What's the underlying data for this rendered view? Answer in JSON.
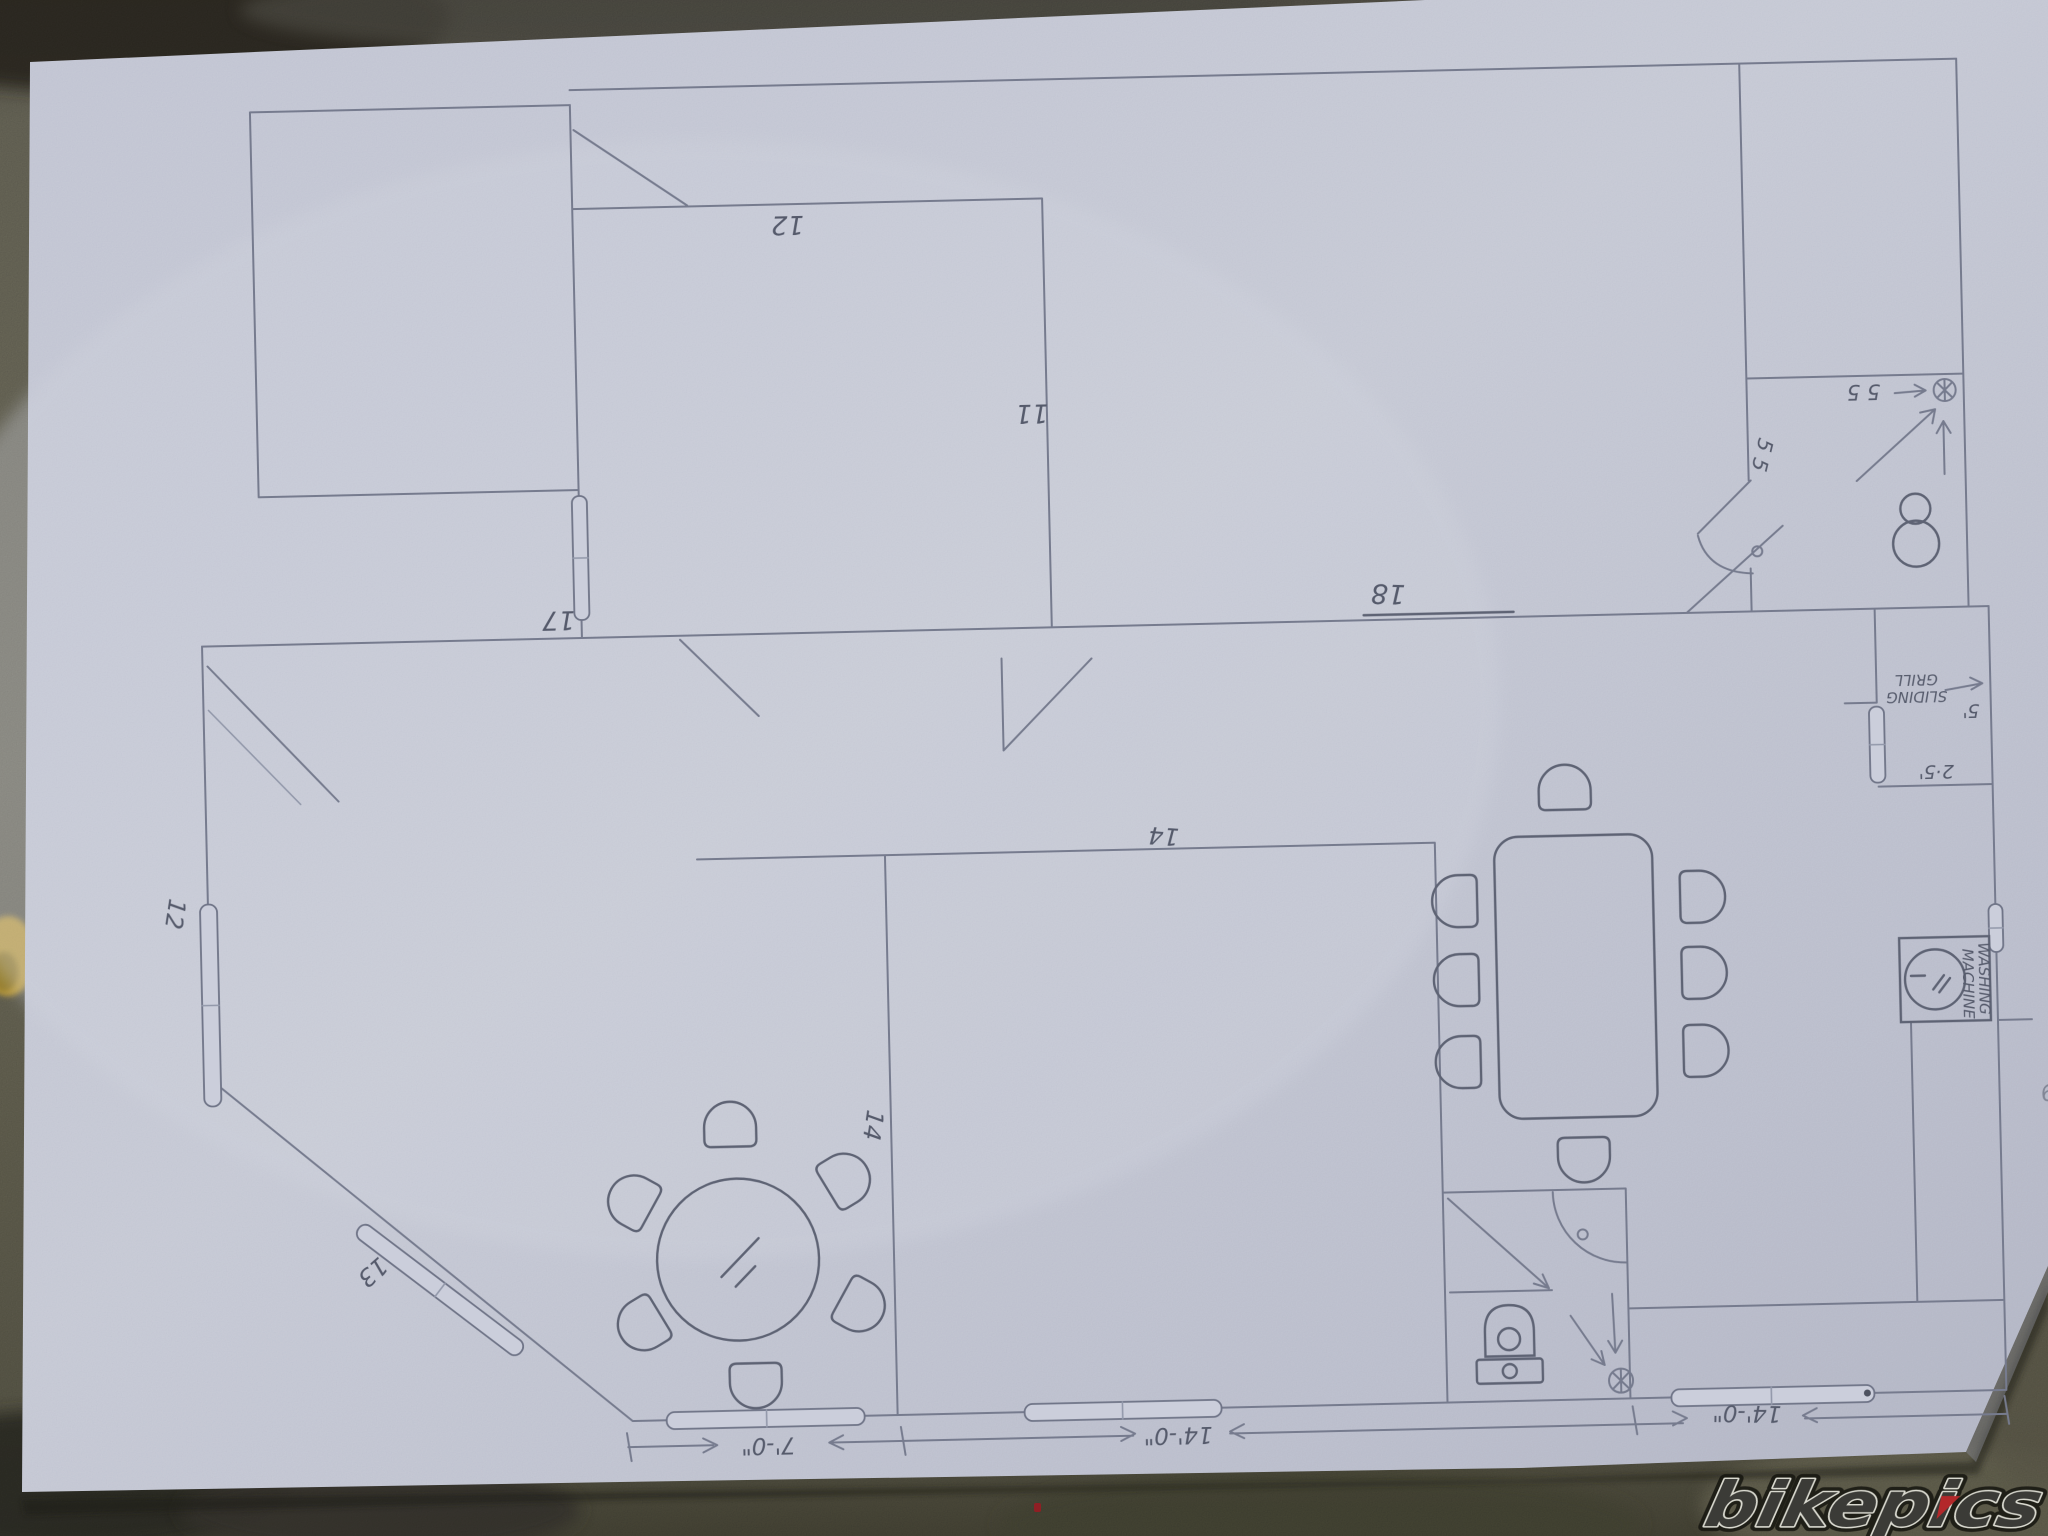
{
  "scene": {
    "description": "photo of a hand-drawn pencil floor plan on paper, upside-down, lying on concrete",
    "paper_color": "#c8cbd8",
    "pencil_color": "#767b8e",
    "concrete_color": "#6e6c5d",
    "watermark": {
      "text": "bikepics",
      "fill": "#3b3b37",
      "outline": "#d9d9cf",
      "accent_red": "#b3282a"
    }
  },
  "plan": {
    "labels": {
      "top_mid_width": "12",
      "top_mid_depth": "11",
      "big_room_width": "18",
      "living_width": "17",
      "left_window": "12",
      "diag_window": "13",
      "family_depth": "14",
      "kitchen_width": "14",
      "bath_dim_h": "5 5",
      "bath_dim_v": "5 5",
      "grill_height": "5'",
      "recess_depth": "2·5'",
      "margin_mark": "9"
    },
    "annotations": {
      "sliding_grill": {
        "line1": "SLIDING",
        "line2": "GRILL"
      },
      "washing_machine": {
        "line1": "WASHING",
        "line2": "MACHINE"
      }
    },
    "dimensions": {
      "left": "7'-0\"",
      "middle": "14'-0\"",
      "right": "14'-0\""
    },
    "furniture": [
      "round-table-with-6-chairs",
      "dining-table-with-8-chairs",
      "toilet-upper-bathroom",
      "toilet-lower-bathroom",
      "washing-machine",
      "capsule-windows",
      "door-swing-arcs",
      "floor-drains"
    ]
  }
}
